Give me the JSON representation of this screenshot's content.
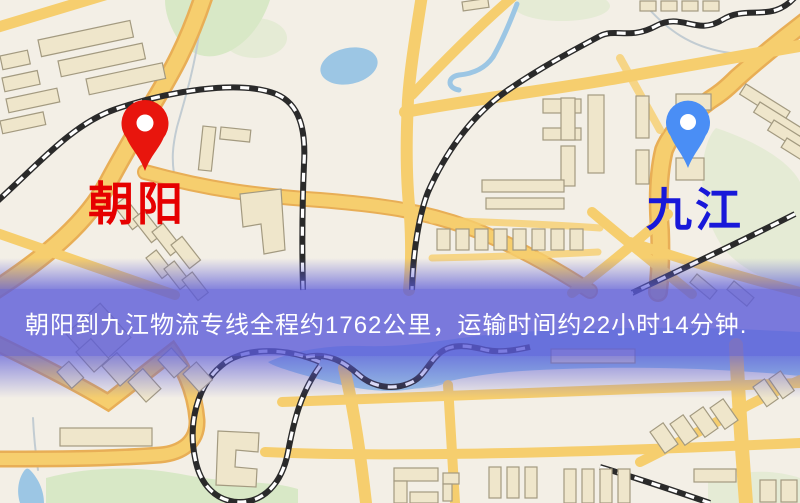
{
  "banner": {
    "text": "朝阳到九江物流专线全程约1762公里，运输时间约22小时14分钟.",
    "background_color": "#5b5bd9cc",
    "text_color": "#ffffff"
  },
  "markers": {
    "origin": {
      "label": "朝阳",
      "label_color": "#e60000",
      "pin_color": "#e8150d",
      "pin_icon": "red-location-pin-icon"
    },
    "destination": {
      "label": "九江",
      "label_color": "#1818d9",
      "pin_color": "#4a8ef5",
      "pin_icon": "blue-location-pin-icon"
    }
  },
  "route_info": {
    "origin": "朝阳",
    "destination": "九江",
    "service": "物流专线",
    "distance": "约1762公里",
    "duration": "约22小时14分钟"
  },
  "map_colors": {
    "background": "#f3efe6",
    "road": "#f6ce6e",
    "road_casing": "#e8ae56",
    "building": "#efe6cb",
    "building_outline": "#a39a80",
    "park": "#d8e8c6",
    "water": "#9cc6e4",
    "railway": "#2a2a2a"
  }
}
